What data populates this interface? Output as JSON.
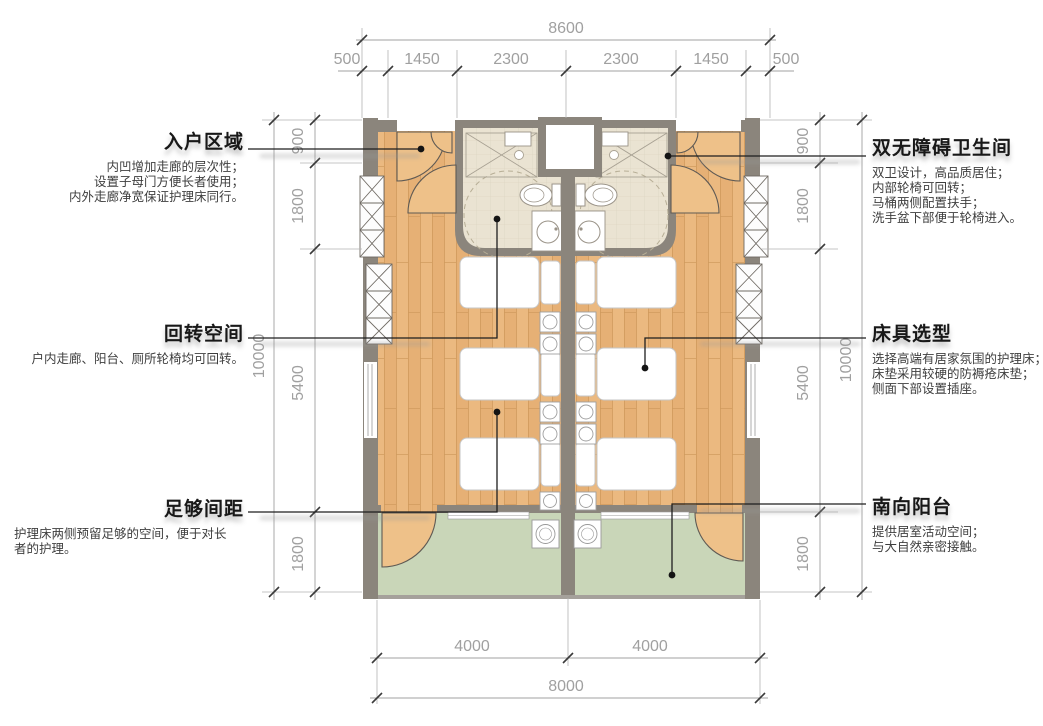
{
  "drawing": {
    "type": "floor-plan",
    "description": "Accessible twin care-room plan with dual barrier-free bathrooms, three nursing beds per room and a south balcony"
  },
  "colors": {
    "wood": "#e6b075",
    "wood-light": "#eec189",
    "wood-line": "#cf9a5d",
    "bath": "#eae3d2",
    "bath-line": "#d9d1bc",
    "balcony": "#c9d6b8",
    "wall": "#8b857c",
    "dim": "#a0a0a0",
    "ext": "#b4b4b4",
    "ink": "#1e1e1e",
    "body-text": "#3e3e3e"
  },
  "dimensions": {
    "top": {
      "total": "8600",
      "seg0": "500",
      "seg1": "1450",
      "seg2": "2300",
      "seg3": "2300",
      "seg4": "1450",
      "seg5": "500"
    },
    "left": {
      "total": "10000",
      "seg0": "900",
      "seg1": "1800",
      "seg2": "5400",
      "seg3": "1800"
    },
    "right": {
      "total": "10000",
      "seg0": "900",
      "seg1": "1800",
      "seg2": "5400",
      "seg3": "1800"
    },
    "bottom": {
      "total": "8000",
      "seg0": "4000",
      "seg1": "4000"
    }
  },
  "annotations": {
    "entry": {
      "title": "入户区域",
      "line0": "内凹增加走廊的层次性；",
      "line1": "设置子母门方便长者使用；",
      "line2": "内外走廊净宽保证护理床同行。"
    },
    "turning": {
      "title": "回转空间",
      "line0": "户内走廊、阳台、厕所轮椅均可回转。"
    },
    "spacing": {
      "title": "足够间距",
      "line0": "护理床两侧预留足够的空间，便于对长者的护理。"
    },
    "bathroom": {
      "title": "双无障碍卫生间",
      "line0": "双卫设计，高品质居住；",
      "line1": "内部轮椅可回转；",
      "line2": "马桶两侧配置扶手；",
      "line3": "洗手盆下部便于轮椅进入。"
    },
    "bed": {
      "title": "床具选型",
      "line0": "选择高端有居家氛围的护理床；",
      "line1": "床垫采用较硬的防褥疮床垫；",
      "line2": "侧面下部设置插座。"
    },
    "balcony": {
      "title": "南向阳台",
      "line0": "提供居室活动空间；",
      "line1": "与大自然亲密接触。"
    }
  }
}
